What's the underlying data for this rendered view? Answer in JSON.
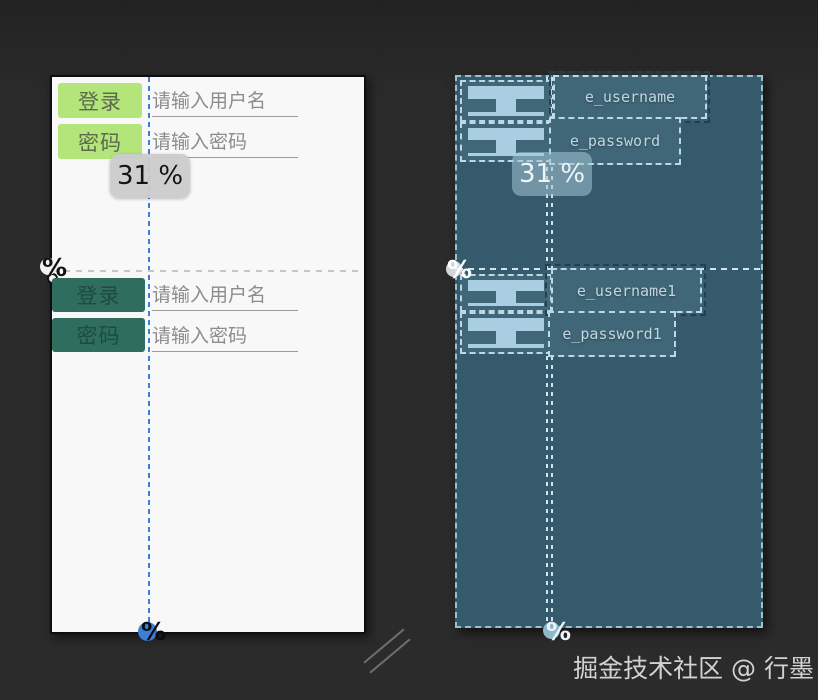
{
  "watermark": "掘金技术社区 @ 行墨",
  "percent_icon": "%",
  "design_view": {
    "percent_tooltip": "31 %",
    "top_form": {
      "login_label": "登录",
      "username_placeholder": "请输入用户名",
      "password_label": "密码",
      "password_placeholder": "请输入密码"
    },
    "bottom_form": {
      "login_label": "登录",
      "username_placeholder": "请输入用户名",
      "password_label": "密码",
      "password_placeholder": "请输入密码"
    }
  },
  "blueprint_view": {
    "percent_tooltip": "31 %",
    "top_form": {
      "username_id": "e_username",
      "password_id": "e_password"
    },
    "bottom_form": {
      "username_id": "e_username1",
      "password_id": "e_password1"
    }
  },
  "colors": {
    "canvas_background": "#2b2b2b",
    "design_surface": "#f8f8f8",
    "button_green_light": "#b3e57a",
    "button_green_dark": "#2f6e5f",
    "guideline_blue": "#3d7ed8",
    "blueprint_surface": "#345a6c",
    "blueprint_outline": "#bcd8e4",
    "hint_gray": "#8c8c8c",
    "tooltip_gray": "#cbcbcb"
  }
}
